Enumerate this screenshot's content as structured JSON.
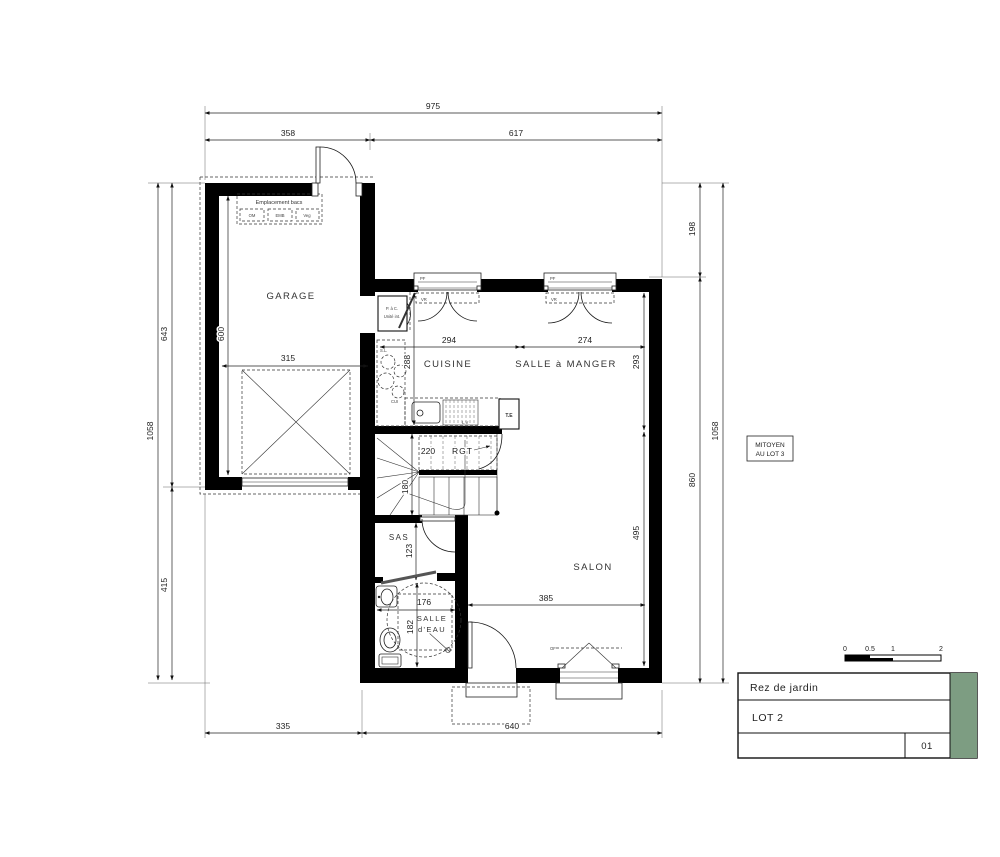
{
  "plan": {
    "rooms": {
      "garage": "GARAGE",
      "cuisine": "CUISINE",
      "salle_a_manger": "SALLE à MANGER",
      "salon": "SALON",
      "sas": "SAS",
      "salle_deau_l1": "SALLE",
      "salle_deau_l2": "d'EAU",
      "rgt": "RGT"
    },
    "ann": {
      "emplacement_bacs": "Emplacement bacs",
      "bac_om": "OM",
      "bac_emb": "EMB",
      "bac_veg": "Veg",
      "pac_l1": "P. à C.",
      "pac_l2": "Unité int.",
      "te": "T.E",
      "sl": "S.L.",
      "lv": "L.V",
      "cui": "CUI",
      "vr1": "VR",
      "vr2": "VR",
      "pf1": "PF",
      "pf2": "PF",
      "of": "OF",
      "mitoyen_l1": "MITOYEN",
      "mitoyen_l2": "AU LOT 3"
    },
    "dims": {
      "w_total": "975",
      "w_garage": "358",
      "w_living": "617",
      "h_total_left": "1058",
      "h_garage": "643",
      "h_below_garage": "415",
      "h_garage_int": "600",
      "w_garage_int": "315",
      "w_cuisine": "294",
      "w_sam": "274",
      "h_cuisine": "288",
      "h_sam": "293",
      "stair_w": "220",
      "stair_h": "180",
      "sas_h": "123",
      "sde_w": "176",
      "sde_h": "182",
      "salon_h": "495",
      "salon_w": "385",
      "h_right_top": "198",
      "h_right_bottom": "860",
      "h_total_right": "1058",
      "w_bottom_left": "335",
      "w_bottom_right": "640"
    }
  },
  "title_block": {
    "floor": "Rez de jardin",
    "lot": "LOT 2",
    "sheet": "01"
  },
  "scale_bar": {
    "t0": "0",
    "t05": "0.5",
    "t1": "1",
    "t2": "2"
  },
  "colors": {
    "wall": "#000000",
    "accent_green": "#7d9d82"
  }
}
